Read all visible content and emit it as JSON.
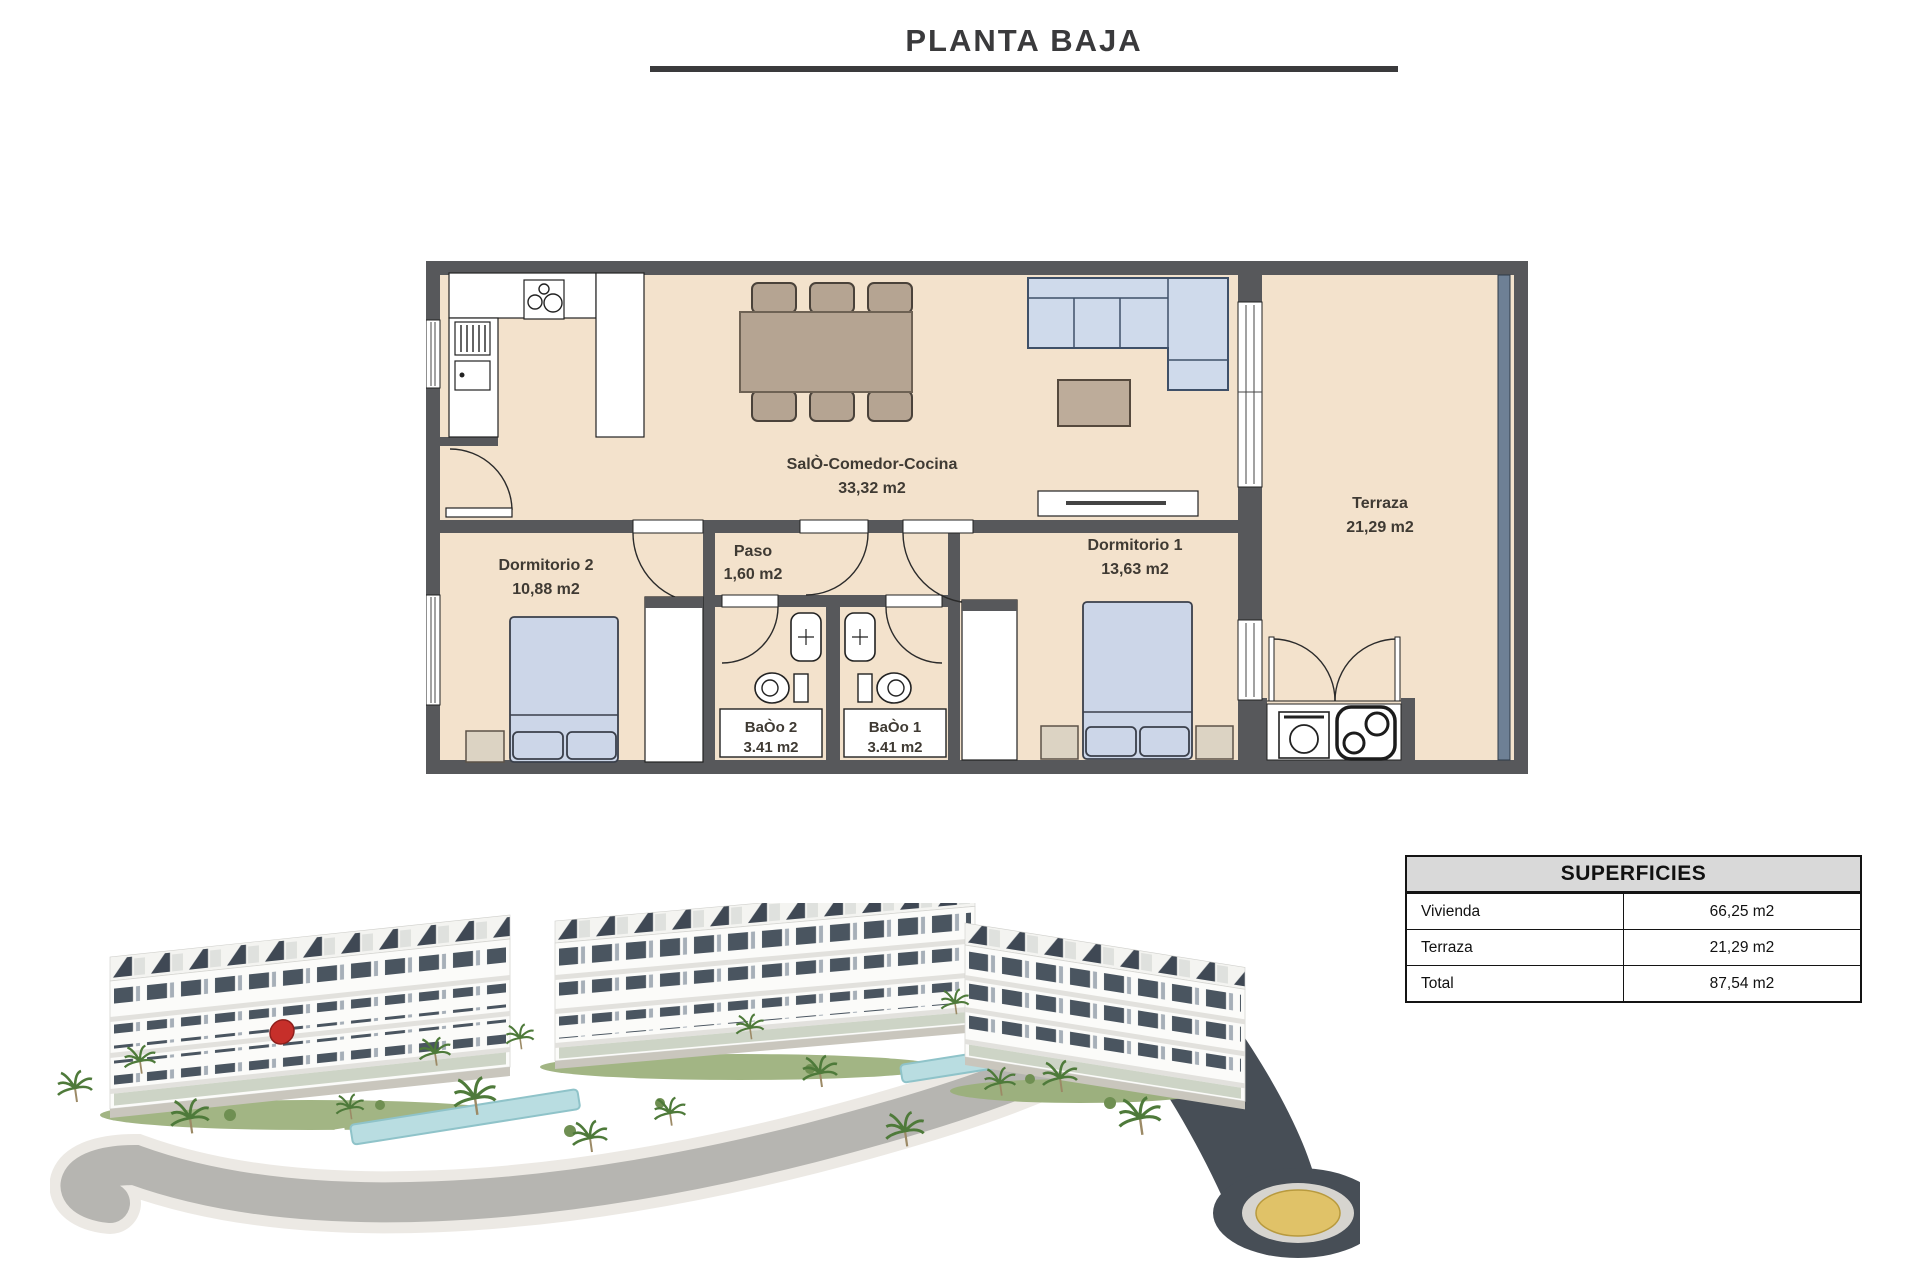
{
  "title": {
    "text": "PLANTA BAJA"
  },
  "floorplan": {
    "salon_name": "SalÒ-Comedor-Cocina",
    "salon_area": "33,32 m2",
    "terraza_name": "Terraza",
    "terraza_area": "21,29 m2",
    "dorm2_name": "Dormitorio 2",
    "dorm2_area": "10,88 m2",
    "paso_name": "Paso",
    "paso_area": "1,60 m2",
    "dorm1_name": "Dormitorio 1",
    "dorm1_area": "13,63 m2",
    "bano2_name": "BaÒo 2",
    "bano2_area": "3.41 m2",
    "bano1_name": "BaÒo 1",
    "bano1_area": "3.41 m2"
  },
  "table": {
    "header": "SUPERFICIES",
    "rows": [
      {
        "label": "Vivienda",
        "value": "66,25 m2"
      },
      {
        "label": "Terraza",
        "value": "21,29 m2"
      },
      {
        "label": "Total",
        "value": "87,54 m2"
      }
    ]
  },
  "colors": {
    "floor_beige": "#f3e2cc",
    "wall_grey": "#57585b",
    "furniture_blue": "#ccd6e8",
    "furniture_tan": "#b5a492",
    "glass_blue": "#6e8095",
    "roundabout_yellow": "#e0c268",
    "title_grey": "#3a3a3c"
  }
}
